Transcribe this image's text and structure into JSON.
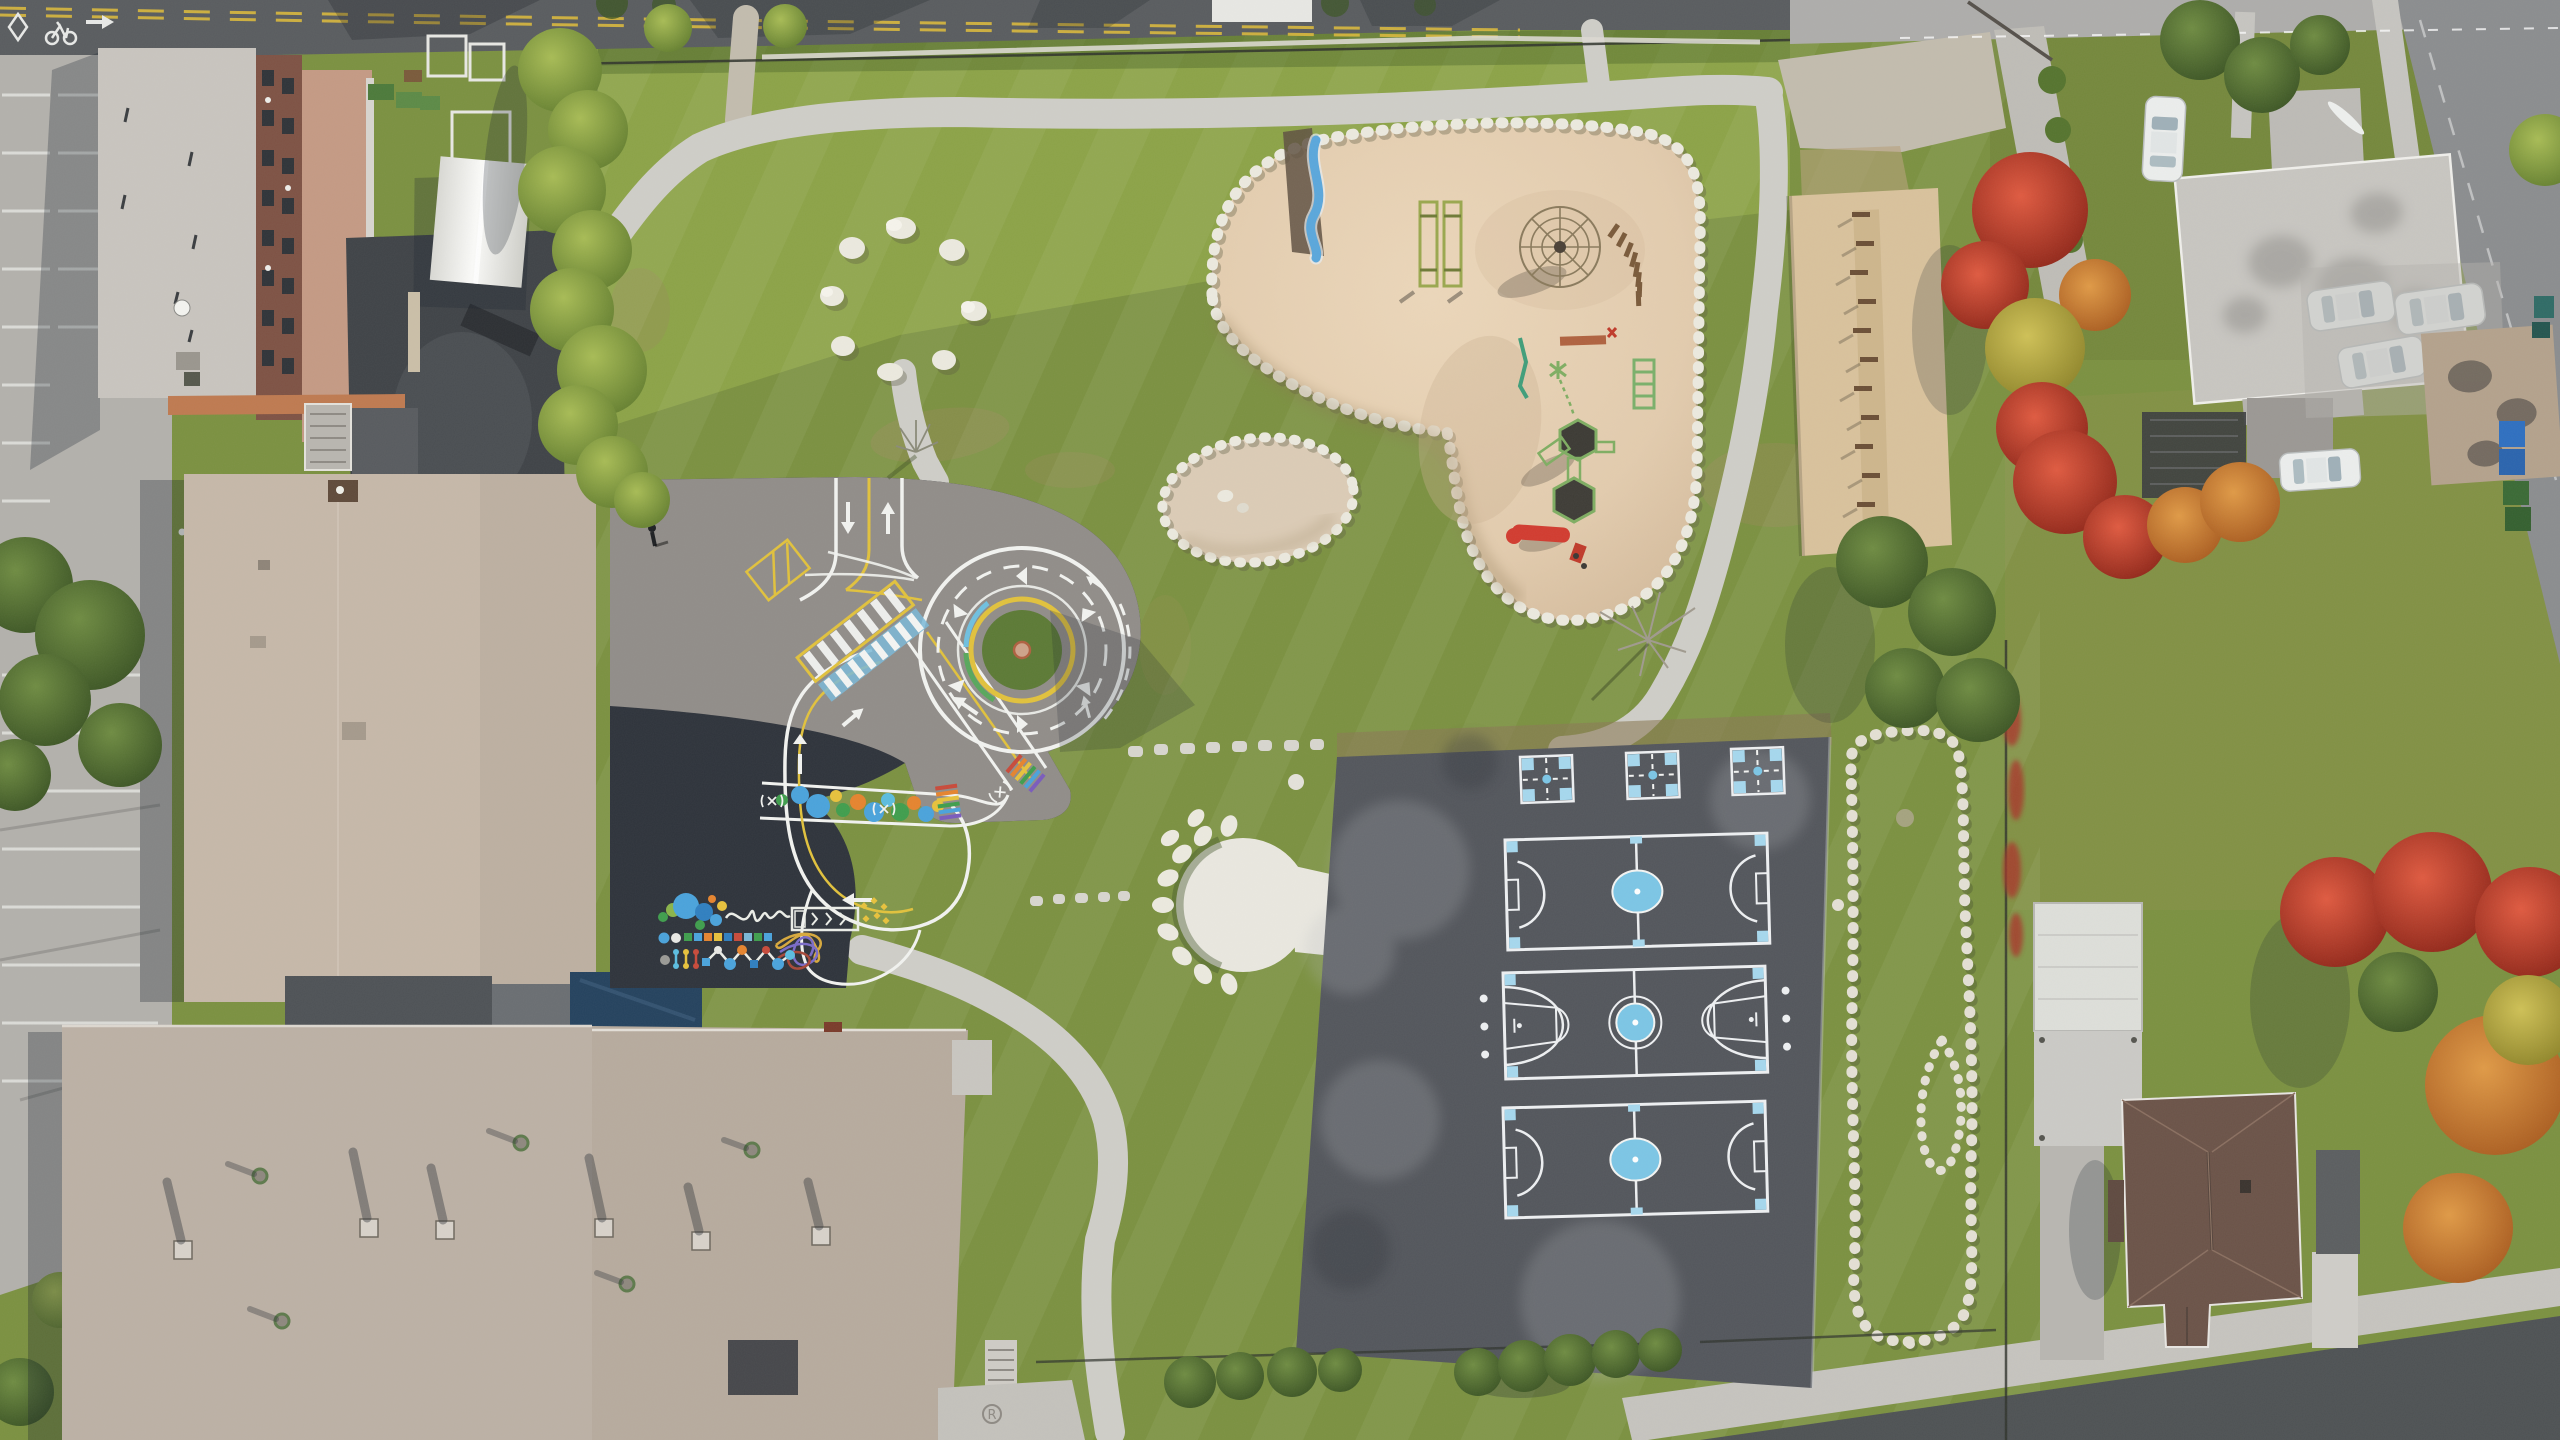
{
  "scene": {
    "type": "aerial-photograph",
    "subject": "schoolyard with playgrounds, painted traffic-training circuit, mini sports courts, stone circles, surrounding streets and houses",
    "season": "autumn",
    "camera": "top-down drone view"
  },
  "features": {
    "pavement_marking_letter": "R",
    "roundabout_direction": "counterclockwise",
    "courts": {
      "four_square": 3,
      "mini_soccer": 2,
      "basketball": 1
    },
    "playground": "sand area with wavy slide, swing frames, dome climber, log path, climbing structure with red slide",
    "bike_lane_symbols": [
      "diamond",
      "bicycle",
      "arrow-right"
    ]
  },
  "palette": {
    "grass_base": "#7b9140",
    "grass_bright": "#a9bf55",
    "grass_olive": "#8a9147",
    "road_top": "#595c5f",
    "road_light": "#aeadab",
    "road_right": "#8b8d8f",
    "road_bottom": "#4e5254",
    "concrete": "#b3b1ac",
    "sidewalk": "#c6c4bf",
    "path": "#cfcec8",
    "gravel": "#c3bcae",
    "apartment_roof": "#c9c5bf",
    "brick": "#7e5244",
    "apartment_roof2": "#c59a84",
    "tent": "#f0f0ed",
    "school_upper_roof": "#c6b8a9",
    "school_lower_roof": "#bcb1a5",
    "navy_roof": "#24425e",
    "gray_roof_section": "#4e5256",
    "asphalt_sun": "#918d89",
    "asphalt_shade": "#2e333b",
    "courts_asphalt": "#53565c",
    "court_line": "#eef0f2",
    "court_blue": "#a6d8ee",
    "court_blue_fill": "#7cc6e6",
    "sand": "#e3ccae",
    "sand_pale": "#dcccb6",
    "sand_white": "#eae8e0",
    "woodchips": "#d9c29c",
    "stone": "#eceadf",
    "marking_white": "#f2f3f0",
    "marking_yellow": "#e2c23c",
    "slide_blue": "#5aa7dc",
    "equip_green": "#7fae62",
    "equip_red": "#d23b2f",
    "tree_green": "#4a6a2e",
    "tree_red": "#c03a2a",
    "tree_orange": "#cf7a2e",
    "tree_yellow": "#b5a63d",
    "hedge": "#8aa04a",
    "house_roof_brown": "#6b5348",
    "roof_gray": "#c8c6c1",
    "roof_white": "#dedfda",
    "shed_tan": "#b4a28c",
    "car_white": "#eceeed",
    "bin_blue": "#2e6fc0",
    "bin_green": "#3a6a35",
    "shadow": "#17212b"
  }
}
